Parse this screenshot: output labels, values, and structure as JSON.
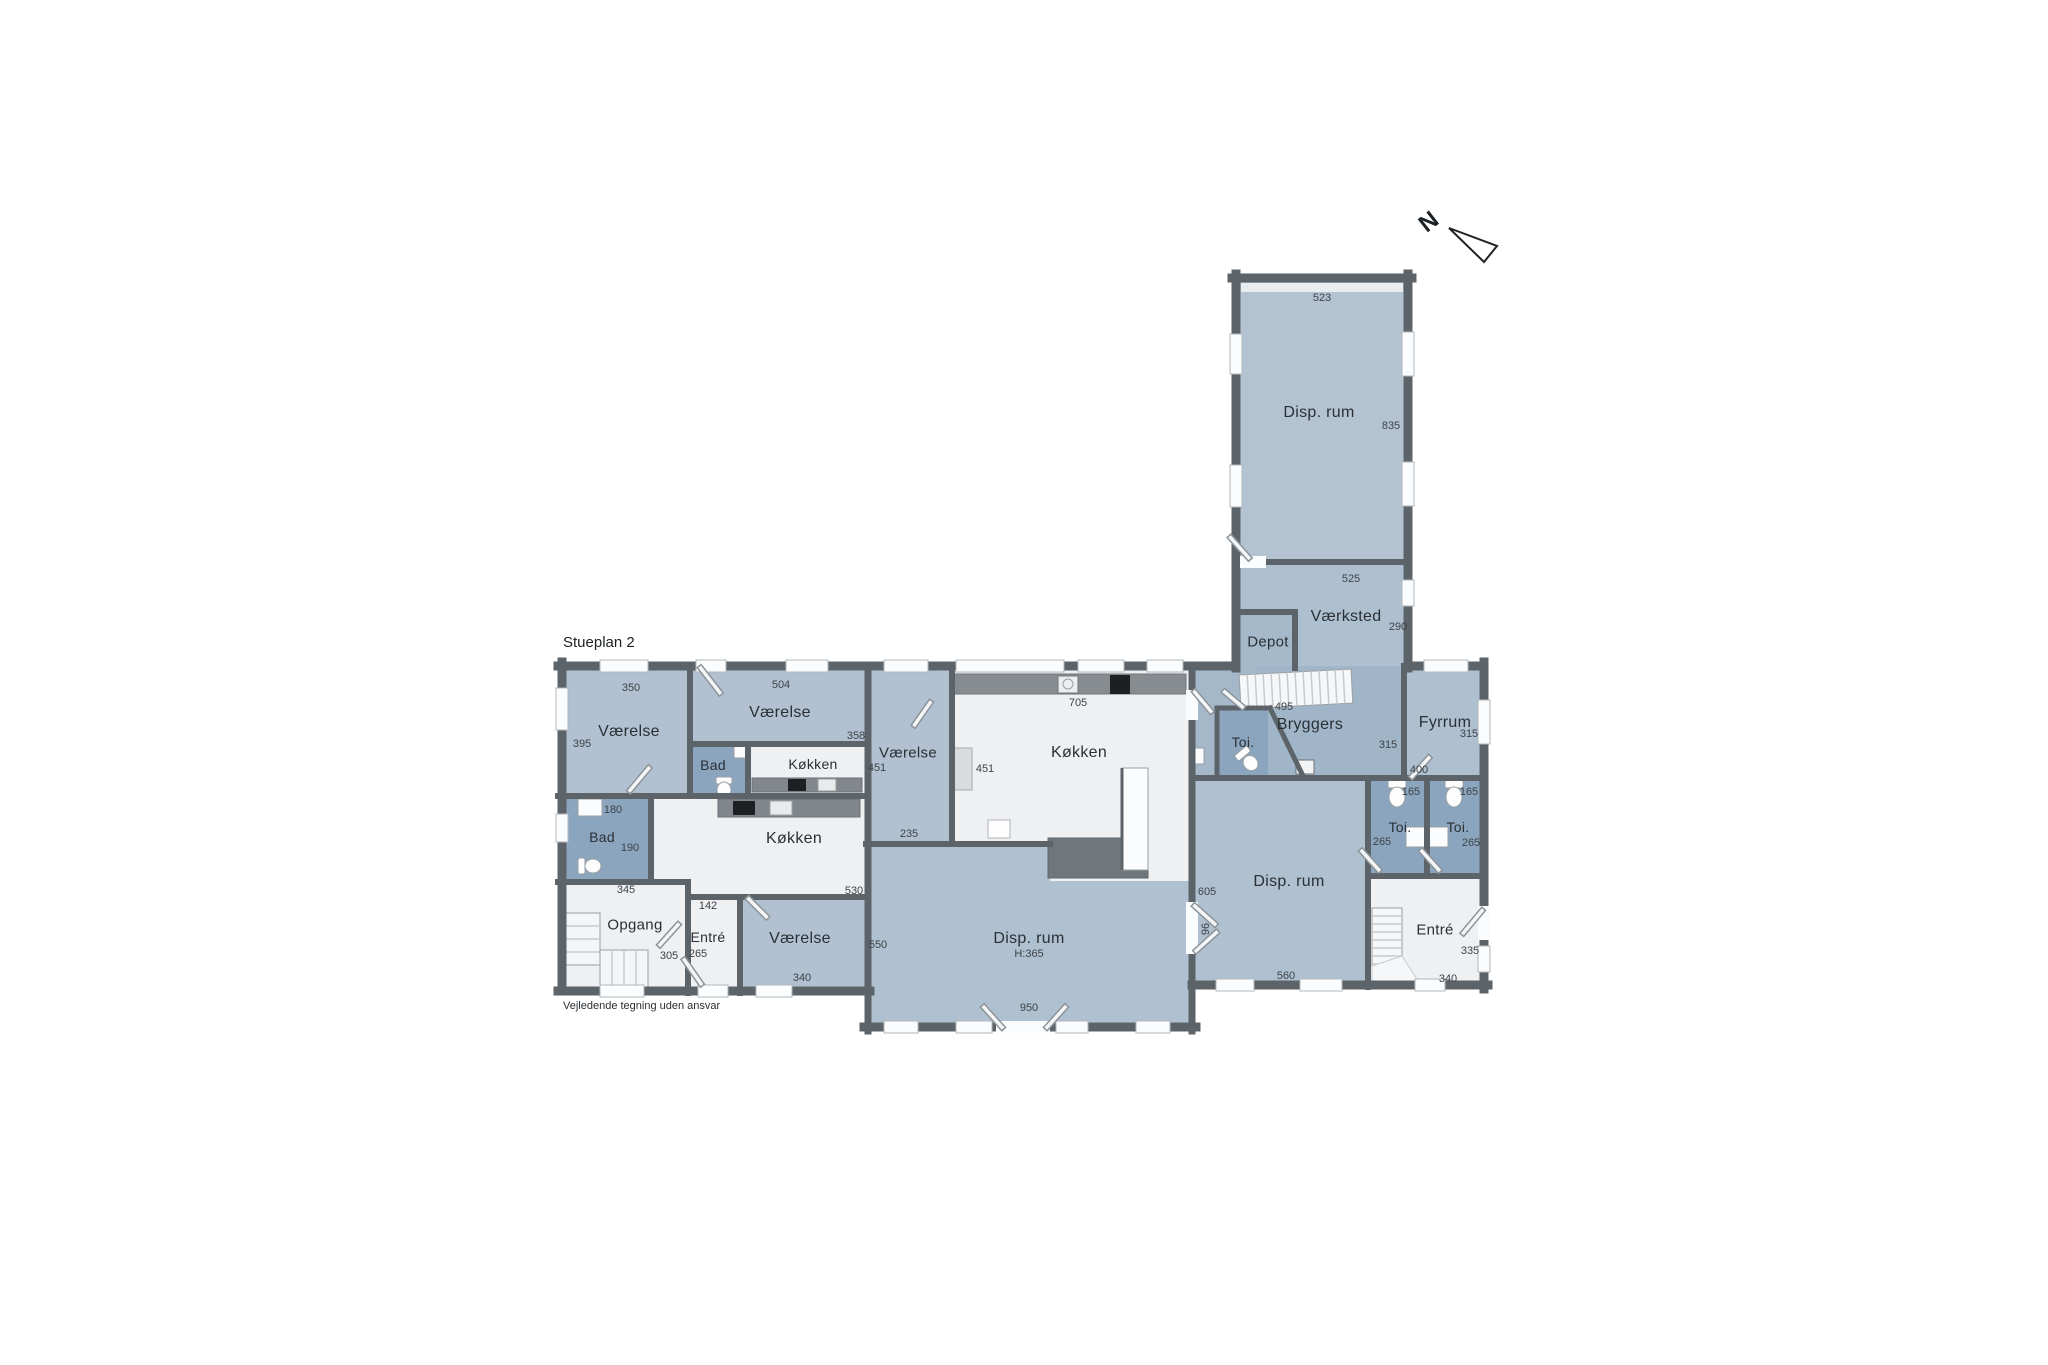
{
  "title": "Stueplan 2",
  "disclaimer": "Vejledende tegning uden ansvar",
  "compass": {
    "north": "N"
  },
  "rooms": {
    "vaerelse": "Værelse",
    "koekken": "Køkken",
    "bad": "Bad",
    "toi": "Toi.",
    "disp_rum": "Disp. rum",
    "vaerksted": "Værksted",
    "depot": "Depot",
    "bryggers": "Bryggers",
    "fyrrum": "Fyrrum",
    "opgang": "Opgang",
    "entre": "Entré"
  },
  "measurements": {
    "m523": "523",
    "m835": "835",
    "m525": "525",
    "m290": "290",
    "m495": "495",
    "m315": "315",
    "m400": "400",
    "m165": "165",
    "m265": "265",
    "m335": "335",
    "m340": "340",
    "m605": "605",
    "m96": "96",
    "m560": "560",
    "m950": "950",
    "m550": "550",
    "m530": "530",
    "m235": "235",
    "m451": "451",
    "m705": "705",
    "m358": "358",
    "m504": "504",
    "m350": "350",
    "m395": "395",
    "m180": "180",
    "m190": "190",
    "m345": "345",
    "m305": "305",
    "m142": "142",
    "height_note": "H:365"
  },
  "colors": {
    "room_fill": "#b1c1d1",
    "wet_room_fill": "#8aa5bd",
    "corridor_fill": "#a4b8ca",
    "floor_fill": "#eef0f2",
    "wall": "#5d6469",
    "counter": "#81878c",
    "appliance": "#1d2023"
  }
}
